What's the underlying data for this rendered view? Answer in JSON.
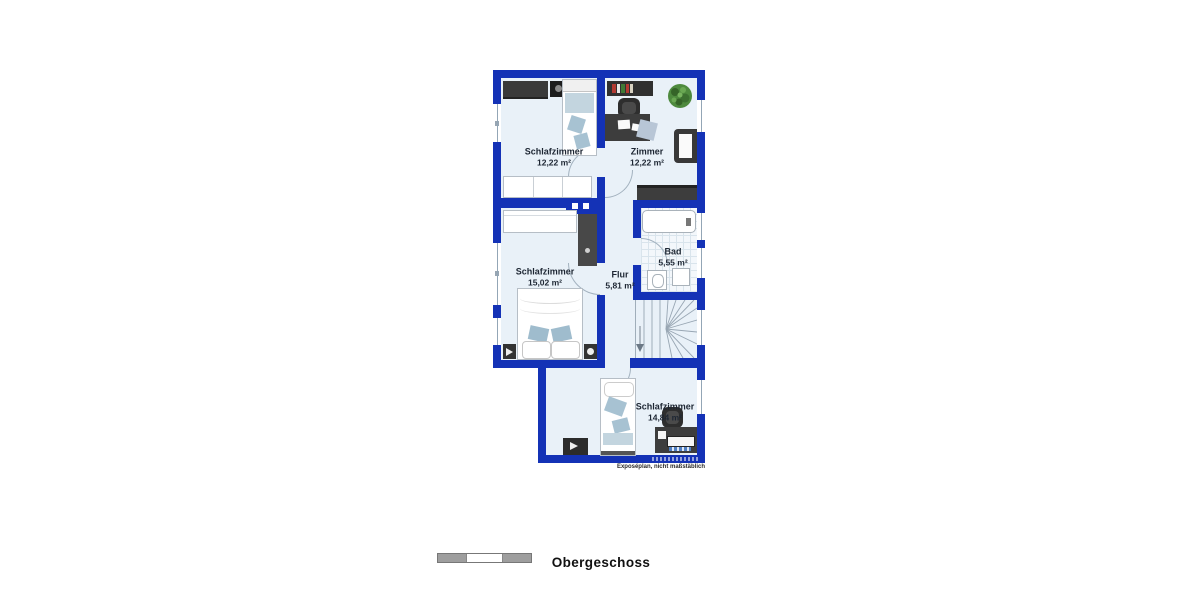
{
  "plan": {
    "rooms": [
      {
        "id": "schlafzimmer-1",
        "name": "Schlafzimmer",
        "area": "12,22 m²"
      },
      {
        "id": "zimmer",
        "name": "Zimmer",
        "area": "12,22 m²"
      },
      {
        "id": "schlafzimmer-2",
        "name": "Schlafzimmer",
        "area": "15,02 m²"
      },
      {
        "id": "flur",
        "name": "Flur",
        "area": "5,81 m²"
      },
      {
        "id": "bad",
        "name": "Bad",
        "area": "5,55 m²"
      },
      {
        "id": "schlafzimmer-3",
        "name": "Schlafzimmer",
        "area": "14,84 m²"
      }
    ],
    "footer": {
      "floor_label": "Obergeschoss",
      "disclaimer": "Exposéplan, nicht maßstäblich"
    },
    "colors": {
      "wall_blue": "#1432b6",
      "floor_light": "#e9f1f8",
      "furniture_dark": "#3a3a3a",
      "textile_light_blue": "#a7c2d2",
      "plant_green": "#4e8a3e"
    }
  }
}
